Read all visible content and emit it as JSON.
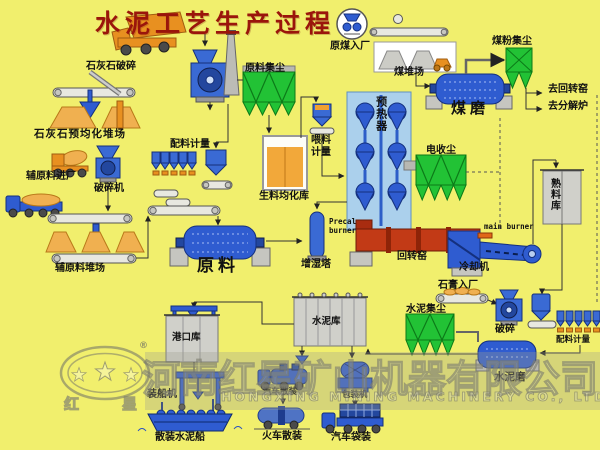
{
  "title": "水泥工艺生产过程",
  "limestone": {
    "crushing": "石灰石破碎",
    "preblending_yard": "石灰石预均化堆场"
  },
  "auxiliary": {
    "entry": "辅原料进厂",
    "crusher": "破碎机",
    "yard": "辅原料堆场"
  },
  "raw": {
    "batching": "配料计量",
    "mill": "原料",
    "dust_collector": "原料集尘",
    "homogenizing_silo": "生料均化库",
    "feed_metering": "喂料计量",
    "preheater": "预热器"
  },
  "coal": {
    "entry": "原煤入厂",
    "yard": "煤堆场",
    "mill": "煤磨",
    "dust_collector": "煤粉集尘",
    "to_rotary_kiln": "去回转窑",
    "to_calciner": "去分解炉"
  },
  "kiln": {
    "precal_burner": "Precal burner",
    "main_burner": "main burner",
    "rotary_kiln": "回转窑",
    "cooler": "冷却机",
    "esp": "电收尘",
    "humidifier_tower": "增湿塔",
    "clinker_silo": "熟料库"
  },
  "cement": {
    "gypsum_entry": "石膏入厂",
    "crushing": "破碎",
    "batching": "配料计量",
    "mill": "水泥磨",
    "dust_collector": "水泥集尘",
    "silo": "水泥库"
  },
  "shipping": {
    "port_silo": "港口库",
    "ship_loader": "装船机",
    "bulk_ship": "散装水泥船",
    "truck_bulk": "汽车散装",
    "train_bulk": "火车散装",
    "packer": "包装机",
    "truck_bag": "汽车袋装"
  },
  "watermark": {
    "company_cn": "河南红星矿山机器有限公司",
    "company_en": "HONGXING MINING MACHINERY CO., LTD",
    "logo_char_left": "红",
    "logo_char_right": "星",
    "registered_mark": "®"
  },
  "colors": {
    "background": "#f1ef6d",
    "title": "#9a150b",
    "equipment_blue": "#2f5cd0",
    "collector_green": "#22c235",
    "material_orange": "#f0b050",
    "kiln_red": "#c23a16",
    "silo_gray": "#d0d0ca",
    "preheater": "#abd0ec"
  }
}
